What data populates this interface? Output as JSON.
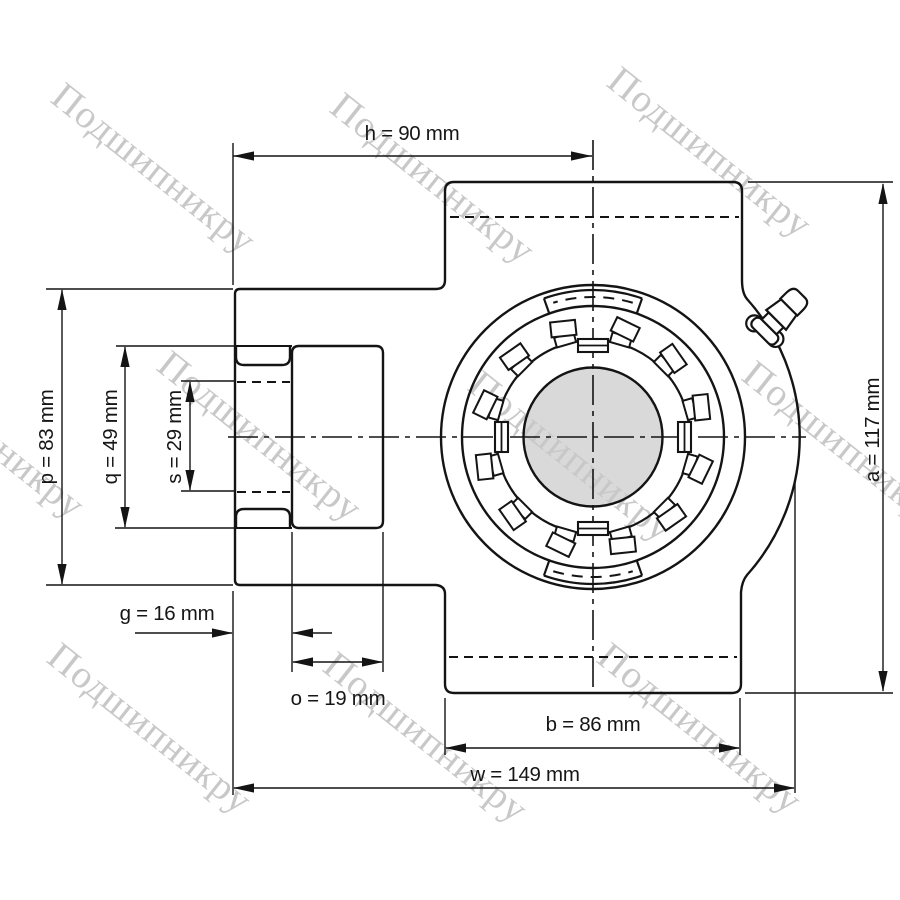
{
  "watermark": {
    "text": "Подшипникру",
    "color": "#c8c8c8"
  },
  "dimensions": {
    "h": "h = 90 mm",
    "p": "p = 83 mm",
    "q": "q = 49 mm",
    "s": "s = 29 mm",
    "g": "g = 16 mm",
    "o": "o = 19 mm",
    "b": "b = 86 mm",
    "w": "w = 149 mm",
    "a": "a = 117 mm"
  },
  "dimension_values": {
    "h": 90,
    "p": 83,
    "q": 49,
    "s": 29,
    "g": 16,
    "o": 19,
    "b": 86,
    "w": 149,
    "a": 117
  },
  "unit": "mm",
  "colors": {
    "line": "#141414",
    "bore_fill": "#d9d9d9",
    "background": "#ffffff",
    "watermark": "#c8c8c8"
  }
}
